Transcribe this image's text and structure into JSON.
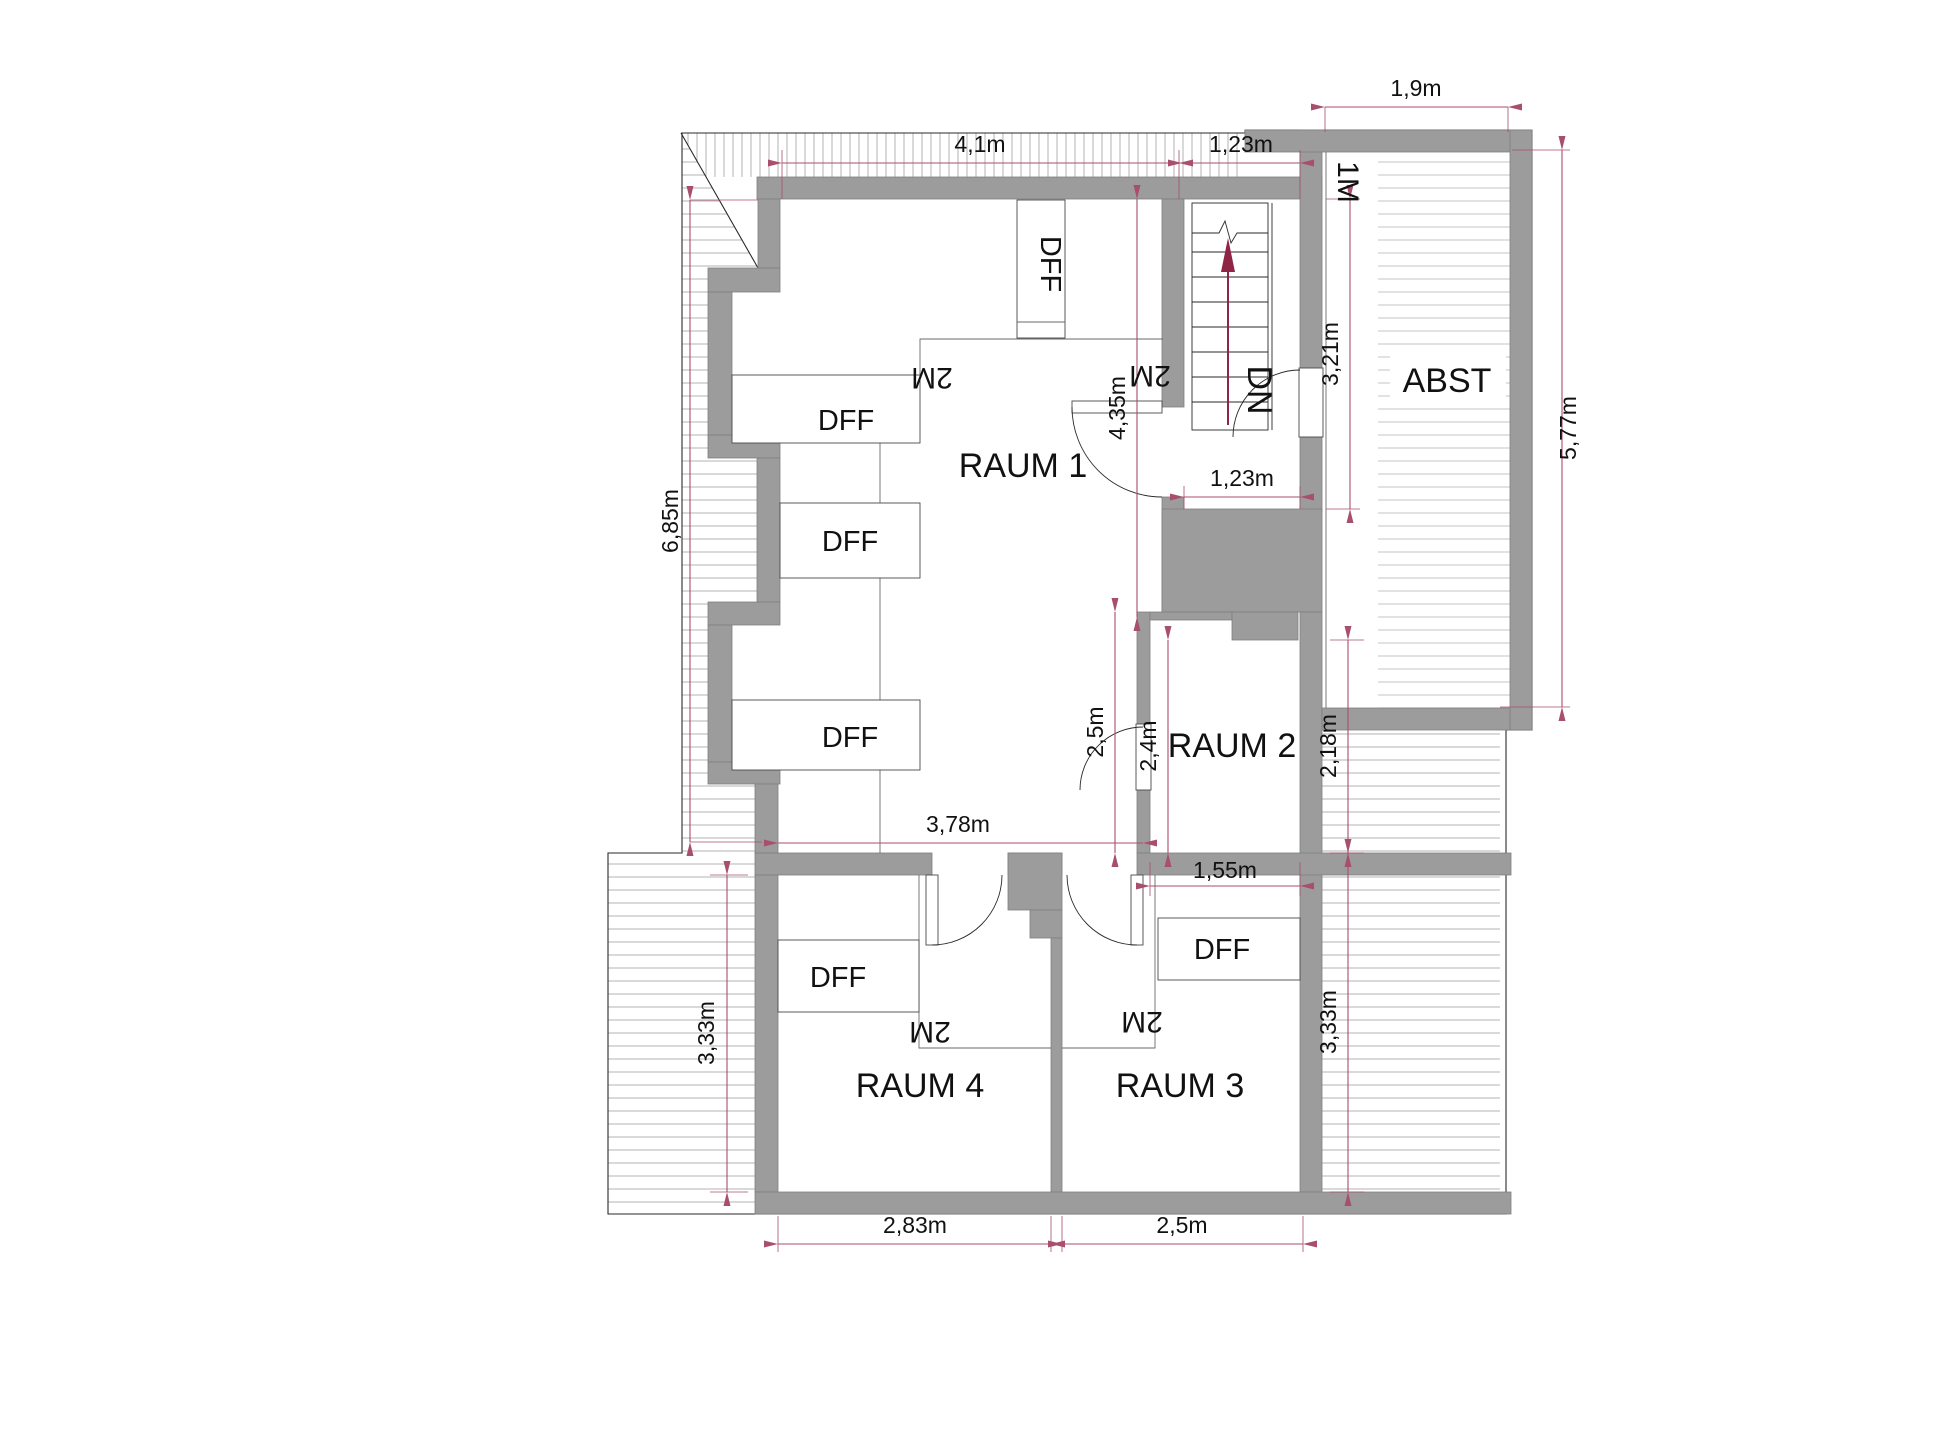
{
  "meta": {
    "drawing_type": "attic floor plan",
    "language": "de"
  },
  "colors": {
    "bg": "#ffffff",
    "wall": "#9c9c9c",
    "wall-edge": "#7f7f7f",
    "line": "#2a2a2a",
    "hatch": "#b3b3b3",
    "plank": "#c6c6c6",
    "dim": "#a84f6b",
    "arrow": "#8f2447",
    "text": "#111111"
  },
  "rooms": {
    "raum1": {
      "label": "RAUM 1"
    },
    "raum2": {
      "label": "RAUM 2"
    },
    "raum3": {
      "label": "RAUM 3"
    },
    "raum4": {
      "label": "RAUM 4"
    },
    "abst": {
      "label": "ABST"
    }
  },
  "stair": {
    "direction_label": "DN"
  },
  "height_markers": {
    "one_meter": "1M",
    "two_meter": "2M"
  },
  "window_label": "DFF",
  "dimensions": [
    {
      "id": "top-width",
      "text": "4,1m"
    },
    {
      "id": "stair-width-top",
      "text": "1,23m"
    },
    {
      "id": "abst-width",
      "text": "1,9m"
    },
    {
      "id": "abst-height",
      "text": "5,77m"
    },
    {
      "id": "stair-height",
      "text": "3,21m"
    },
    {
      "id": "raum1-height",
      "text": "4,35m"
    },
    {
      "id": "landing-width",
      "text": "1,23m"
    },
    {
      "id": "left-height",
      "text": "6,85m"
    },
    {
      "id": "raum1-width",
      "text": "3,78m"
    },
    {
      "id": "alcove-height",
      "text": "2,5m"
    },
    {
      "id": "raum2-height",
      "text": "2,4m"
    },
    {
      "id": "raum2-width",
      "text": "1,55m"
    },
    {
      "id": "roof-right-upper",
      "text": "2,18m"
    },
    {
      "id": "roof-right-lower",
      "text": "3,33m"
    },
    {
      "id": "roof-left-lower",
      "text": "3,33m"
    },
    {
      "id": "raum4-width",
      "text": "2,83m"
    },
    {
      "id": "raum3-width",
      "text": "2,5m"
    }
  ]
}
